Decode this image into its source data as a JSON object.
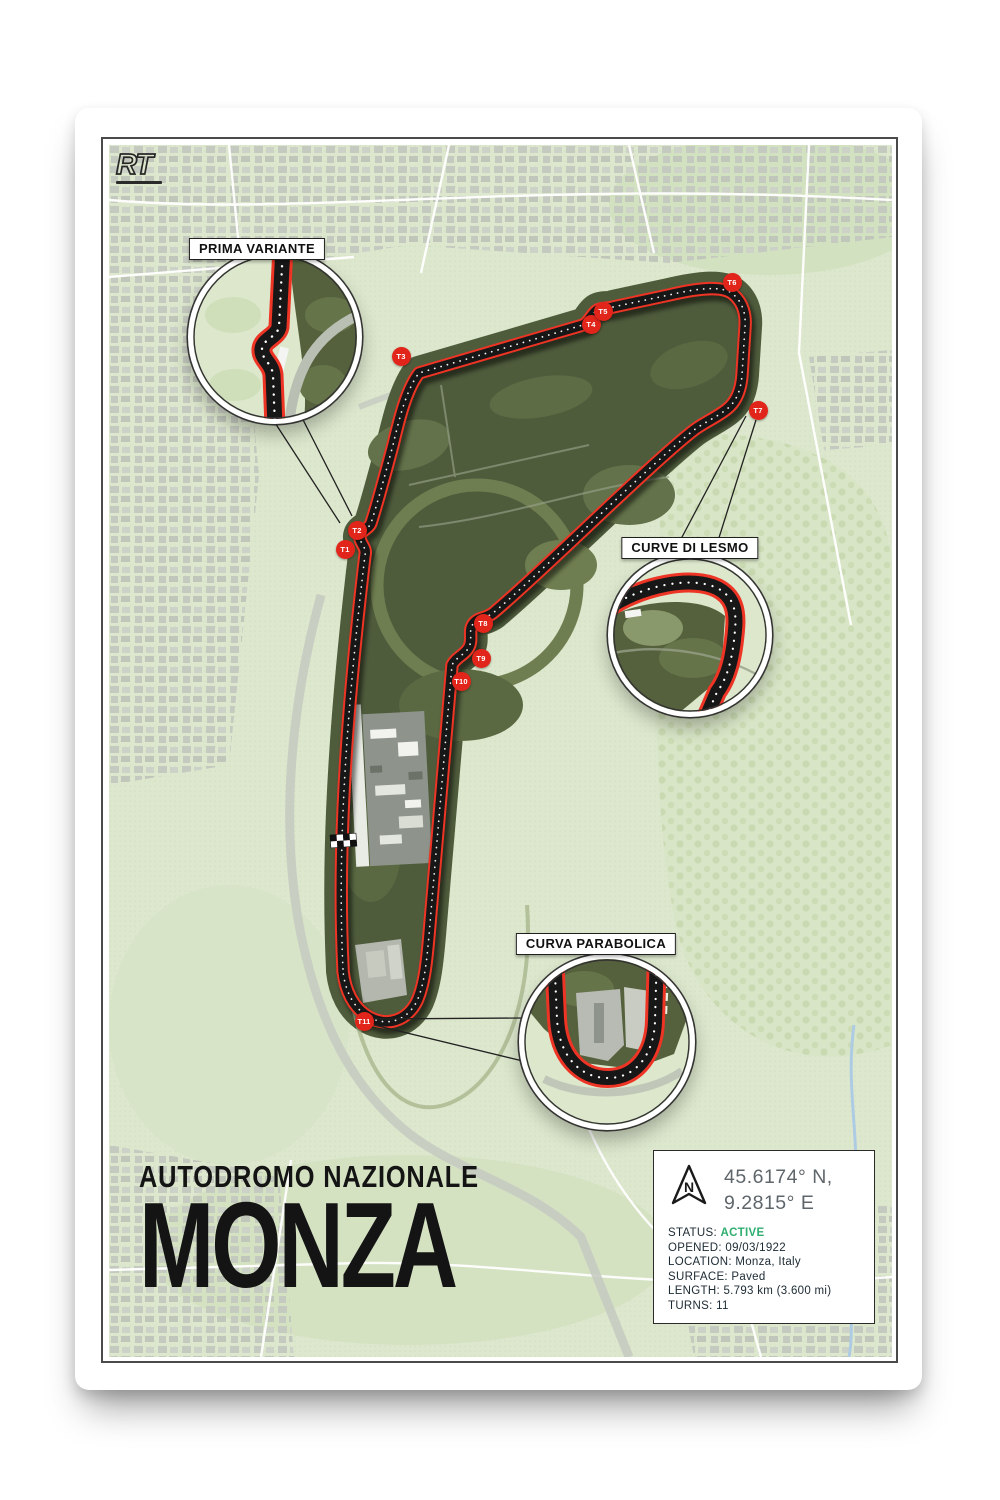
{
  "poster": {
    "brand": {
      "logo": "RT"
    },
    "title": {
      "kicker": "AUTODROMO NAZIONALE",
      "name": "MONZA"
    },
    "insets": [
      {
        "label": "PRIMA VARIANTE"
      },
      {
        "label": "CURVE DI LESMO"
      },
      {
        "label": "CURVA PARABOLICA"
      }
    ],
    "turns": [
      {
        "label": "T1"
      },
      {
        "label": "T2"
      },
      {
        "label": "T3"
      },
      {
        "label": "T4"
      },
      {
        "label": "T5"
      },
      {
        "label": "T6"
      },
      {
        "label": "T7"
      },
      {
        "label": "T8"
      },
      {
        "label": "T9"
      },
      {
        "label": "T10"
      },
      {
        "label": "T11"
      }
    ],
    "info": {
      "north_label": "N",
      "coordinates_line1": "45.6174° N,",
      "coordinates_line2": "9.2815° E",
      "rows": [
        {
          "label": "STATUS:",
          "value": "ACTIVE"
        },
        {
          "label": "OPENED:",
          "value": "09/03/1922"
        },
        {
          "label": "LOCATION:",
          "value": "Monza, Italy"
        },
        {
          "label": "SURFACE:",
          "value": "Paved"
        },
        {
          "label": "LENGTH:",
          "value": "5.793 km (3.600 mi)"
        },
        {
          "label": "TURNS:",
          "value": "11"
        }
      ]
    },
    "colors": {
      "track_red": "#ee3424",
      "track_black": "#171717",
      "status_green": "#2fae70",
      "map_background": "#dce7cd",
      "forest_green": "#4f5c3c",
      "marker_red": "#e2251b"
    }
  }
}
